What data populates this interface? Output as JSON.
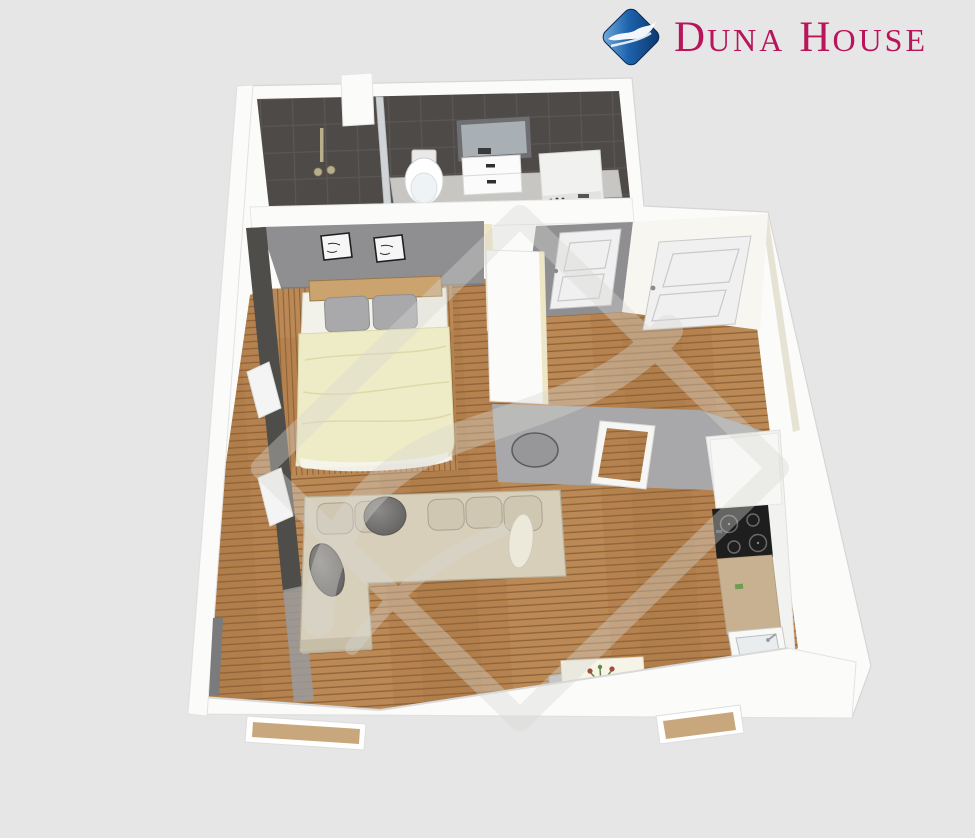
{
  "logo": {
    "brand": "Duna House",
    "word1_initial": "D",
    "word1_rest": "una",
    "word2_initial": "H",
    "word2_rest": "ouse"
  },
  "colors": {
    "background": "#e6e6e7",
    "logo_red": "#b8155a",
    "logo_blue_light": "#7db3e2",
    "logo_blue_mid": "#1d63ad",
    "logo_blue_dark": "#0a3468",
    "wall_white": "#fbfbfa",
    "wall_shadow": "#d9d9d9",
    "wall_cream": "#efe6c4",
    "wall_khaki": "#d6cfb4",
    "bath_floor": "#4e4a47",
    "bath_line": "#5b5754",
    "bath_counter": "#c7c6c2",
    "dark_wall": "#4f4d4a",
    "gray_wall": "#8f8f91",
    "entry_floor": "#a8a8aa",
    "rug": "#97979a",
    "rug_rim": "#5d5d5f",
    "wood": "#b5824f",
    "wood_seam": "#8f6236",
    "wood_light": "#c39866",
    "door_face": "#f0f0f0",
    "door_line": "#c9c9cb",
    "sofa_base": "#d8cfbb",
    "sofa_edge": "#b7ae98",
    "cushion": "#cfc7b1",
    "cushion_edge": "#aaa290",
    "pillow_dark": "#716f6d",
    "pillow_light": "#ece9db",
    "bed_sheet": "#f3f2ea",
    "headboard": "#caa36f",
    "bed_pillow": "#a9a9ac",
    "blanket": "#eeecc6",
    "blanket_fold": "#dbd7a5",
    "cooktop": "#1e1e1e",
    "counter_tan": "#c8b190",
    "sill_tan": "#c9a77c",
    "table_top": "#f6f4e7",
    "chair_gray": "#bcbcbe",
    "plant_green": "#5f8a45",
    "plant_red": "#9c4f3d",
    "glass": "#e8edf0",
    "watermark": "#d8d8d3"
  }
}
